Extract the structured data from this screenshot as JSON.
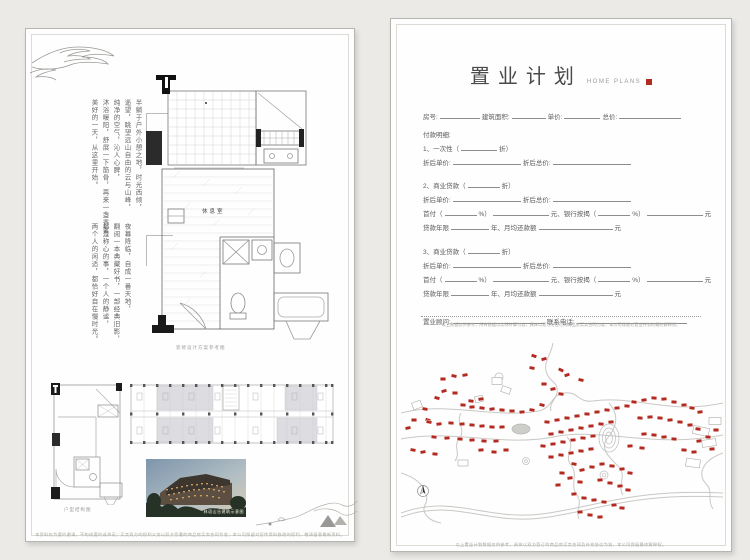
{
  "left_page": {
    "poem_block1": [
      "半躺于户外小憩之地，时光西倾，",
      "遥望，眺望远山自由的云与山峰，",
      "纯净的空气，沁人心脾，",
      "沐浴暖阳，舒展一下筋骨，再来一盏香茗，",
      "美好的一天，从这里开始。"
    ],
    "poem_block2": [
      "夜幕降临，自成一番天地，",
      "翻阅一本典藏好书，一部经典旧影，",
      "都是称心的事，一个人的静谧，",
      "两个人的闲适，都恰好自在慢时光。"
    ],
    "plan_room_label": "休息室",
    "plan_caption": "装修设计方案参考图",
    "structure_caption": "户型结构图",
    "photo_caption": "林语山谷建筑示意图",
    "footer": "本资料仅为要约邀请，不构成要约或承诺；买卖双方的权利义务以双方签署的商品房买卖合同为准；本公司保留对宣传资料修改的权利，敬请留意最新资料。"
  },
  "right_page": {
    "title": "置业计划",
    "subtitle": "HOME PLANS",
    "form": {
      "rows": [
        {
          "mt": 0,
          "parts": [
            "房号:",
            40,
            "建筑面积:",
            34,
            "单价:",
            36,
            "总价:",
            62
          ]
        },
        {
          "mt": 8,
          "parts": [
            "付款明细:"
          ]
        },
        {
          "mt": 4,
          "parts": [
            "1、一次性（",
            36,
            "折）"
          ]
        },
        {
          "mt": 4,
          "parts": [
            "折后单价:",
            68,
            "折后总价:",
            78
          ]
        },
        {
          "mt": 13,
          "parts": [
            "2、商业贷款（",
            32,
            "折）"
          ]
        },
        {
          "mt": 4,
          "parts": [
            "折后单价:",
            68,
            "折后总价:",
            78
          ]
        },
        {
          "mt": 4,
          "parts": [
            "首付（",
            32,
            "%）",
            56,
            "元、银行按揭（",
            32,
            "%）",
            56,
            "元"
          ]
        },
        {
          "mt": 4,
          "parts": [
            "贷款年限",
            38,
            "年、月均还款额",
            74,
            "元"
          ]
        },
        {
          "mt": 14,
          "parts": [
            "3、商业贷款（",
            32,
            "折）"
          ]
        },
        {
          "mt": 4,
          "parts": [
            "折后单价:",
            68,
            "折后总价:",
            78
          ]
        },
        {
          "mt": 4,
          "parts": [
            "首付（",
            32,
            "%）",
            56,
            "元、银行按揭（",
            32,
            "%）",
            56,
            "元"
          ]
        },
        {
          "mt": 4,
          "parts": [
            "贷款年限",
            38,
            "年、月均还款额",
            74,
            "元"
          ]
        },
        {
          "mt": 18,
          "parts": [
            "置业顾问:",
            92,
            "联系电话:",
            110
          ]
        }
      ]
    },
    "note": "以上数据仅供参考，所有数据以实际计算为准，具体以双方所签订的商品房买卖合同为准，本公司保留对置业计划的最终解释权。",
    "footer": "以上置业计划数据仅供参考，具体以双方签订的商品房买卖合同及补充协议为准，本公司保留最终解释权。"
  },
  "colors": {
    "accent_red": "#b32a21",
    "road_gray": "#c9c8c5"
  },
  "map": {
    "roads": [
      "M152,0 C150,12 143,18 145,28 C148,40 158,38 156,50 C154,58 148,60 150,68",
      "M0,70 C45,58 95,76 138,68 C152,64 150,52 163,50 C178,48 176,60 192,58 C235,52 268,72 322,60",
      "M0,96 C52,86 102,104 152,94 C202,84 252,106 322,92",
      "M166,94 C176,104 162,112 170,122 C178,132 168,142 176,152 C182,160 174,168 178,176",
      "M208,60 C220,74 214,86 206,96 C198,106 210,116 218,124 C226,132 216,144 222,152",
      "M60,70 C54,80 66,86 58,96 C52,104 60,110 54,118",
      "M0,170 C55,150 85,180 148,170 C205,161 235,146 322,150",
      "M0,174 C55,154 85,184 148,174 C205,165 235,150 322,154",
      "M0,130 C20,136 30,150 24,162 C20,170 28,178 40,180",
      "M322,110 C300,118 296,132 306,142 C312,148 306,158 312,166"
    ],
    "outlines": [
      [
        96,
        38,
        10,
        7,
        0
      ],
      [
        105,
        47,
        9,
        6,
        20
      ],
      [
        78,
        56,
        8,
        6,
        -15
      ],
      [
        300,
        88,
        16,
        8,
        12
      ],
      [
        308,
        100,
        14,
        7,
        -8
      ],
      [
        314,
        78,
        12,
        7,
        0
      ],
      [
        292,
        120,
        14,
        8,
        8
      ],
      [
        62,
        120,
        10,
        6,
        0
      ],
      [
        16,
        62,
        9,
        7,
        -20
      ]
    ],
    "markers": [
      [
        133,
        13,
        20
      ],
      [
        143,
        16,
        -15
      ],
      [
        131,
        25,
        10
      ],
      [
        160,
        27,
        25
      ],
      [
        166,
        32,
        -20
      ],
      [
        180,
        37,
        12
      ],
      [
        143,
        41,
        0
      ],
      [
        152,
        46,
        -12
      ],
      [
        160,
        51,
        8
      ],
      [
        42,
        36,
        0
      ],
      [
        53,
        33,
        12
      ],
      [
        64,
        32,
        -10
      ],
      [
        36,
        55,
        15
      ],
      [
        54,
        50,
        0
      ],
      [
        43,
        48,
        -18
      ],
      [
        24,
        66,
        10
      ],
      [
        13,
        77,
        0
      ],
      [
        27,
        77,
        18
      ],
      [
        7,
        85,
        -12
      ],
      [
        70,
        58,
        8
      ],
      [
        80,
        56,
        -8
      ],
      [
        62,
        62,
        5
      ],
      [
        71,
        64,
        -5
      ],
      [
        81,
        65,
        8
      ],
      [
        91,
        66,
        -8
      ],
      [
        101,
        67,
        5
      ],
      [
        111,
        68,
        0
      ],
      [
        121,
        69,
        -6
      ],
      [
        131,
        67,
        10
      ],
      [
        141,
        62,
        14
      ],
      [
        28,
        79,
        10
      ],
      [
        38,
        81,
        -8
      ],
      [
        50,
        80,
        5
      ],
      [
        61,
        81,
        -5
      ],
      [
        71,
        82,
        6
      ],
      [
        81,
        83,
        -6
      ],
      [
        91,
        84,
        4
      ],
      [
        101,
        84,
        -4
      ],
      [
        33,
        94,
        8
      ],
      [
        46,
        95,
        -6
      ],
      [
        59,
        96,
        5
      ],
      [
        71,
        97,
        -5
      ],
      [
        83,
        98,
        6
      ],
      [
        95,
        98,
        -4
      ],
      [
        12,
        107,
        10
      ],
      [
        22,
        109,
        -10
      ],
      [
        34,
        111,
        6
      ],
      [
        80,
        107,
        -6
      ],
      [
        93,
        109,
        5
      ],
      [
        105,
        107,
        0
      ],
      [
        146,
        79,
        6
      ],
      [
        156,
        77,
        -6
      ],
      [
        166,
        75,
        5
      ],
      [
        176,
        73,
        -5
      ],
      [
        186,
        71,
        4
      ],
      [
        196,
        69,
        -4
      ],
      [
        206,
        67,
        6
      ],
      [
        216,
        65,
        -6
      ],
      [
        226,
        63,
        5
      ],
      [
        150,
        91,
        -5
      ],
      [
        160,
        89,
        5
      ],
      [
        170,
        87,
        -5
      ],
      [
        180,
        85,
        5
      ],
      [
        190,
        83,
        -5
      ],
      [
        200,
        81,
        5
      ],
      [
        210,
        79,
        -5
      ],
      [
        142,
        103,
        6
      ],
      [
        152,
        101,
        -6
      ],
      [
        162,
        99,
        5
      ],
      [
        172,
        97,
        -5
      ],
      [
        182,
        95,
        5
      ],
      [
        192,
        93,
        -5
      ],
      [
        150,
        114,
        0
      ],
      [
        160,
        112,
        6
      ],
      [
        170,
        110,
        -6
      ],
      [
        180,
        108,
        5
      ],
      [
        190,
        106,
        -5
      ],
      [
        233,
        59,
        8
      ],
      [
        243,
        57,
        -8
      ],
      [
        253,
        55,
        6
      ],
      [
        263,
        56,
        -6
      ],
      [
        273,
        59,
        5
      ],
      [
        283,
        62,
        -5
      ],
      [
        291,
        65,
        8
      ],
      [
        299,
        69,
        -8
      ],
      [
        239,
        75,
        5
      ],
      [
        249,
        74,
        -5
      ],
      [
        259,
        75,
        6
      ],
      [
        269,
        77,
        -6
      ],
      [
        279,
        79,
        5
      ],
      [
        289,
        82,
        -5
      ],
      [
        297,
        86,
        8
      ],
      [
        243,
        91,
        -6
      ],
      [
        253,
        92,
        6
      ],
      [
        263,
        94,
        -5
      ],
      [
        273,
        96,
        5
      ],
      [
        298,
        98,
        -8
      ],
      [
        307,
        94,
        6
      ],
      [
        315,
        87,
        0
      ],
      [
        283,
        107,
        5
      ],
      [
        293,
        109,
        -5
      ],
      [
        241,
        105,
        6
      ],
      [
        229,
        103,
        -6
      ],
      [
        311,
        106,
        -5
      ],
      [
        173,
        121,
        10
      ],
      [
        181,
        127,
        -10
      ],
      [
        191,
        124,
        5
      ],
      [
        201,
        121,
        -5
      ],
      [
        211,
        123,
        6
      ],
      [
        221,
        126,
        -6
      ],
      [
        229,
        130,
        8
      ],
      [
        169,
        135,
        -8
      ],
      [
        179,
        139,
        6
      ],
      [
        199,
        137,
        -6
      ],
      [
        209,
        140,
        5
      ],
      [
        219,
        143,
        -5
      ],
      [
        227,
        147,
        6
      ],
      [
        173,
        151,
        -6
      ],
      [
        183,
        155,
        5
      ],
      [
        193,
        157,
        -5
      ],
      [
        203,
        159,
        6
      ],
      [
        213,
        162,
        -6
      ],
      [
        221,
        165,
        5
      ],
      [
        179,
        169,
        -5
      ],
      [
        189,
        172,
        5
      ],
      [
        199,
        174,
        -5
      ],
      [
        161,
        130,
        4
      ],
      [
        157,
        142,
        -4
      ]
    ]
  }
}
